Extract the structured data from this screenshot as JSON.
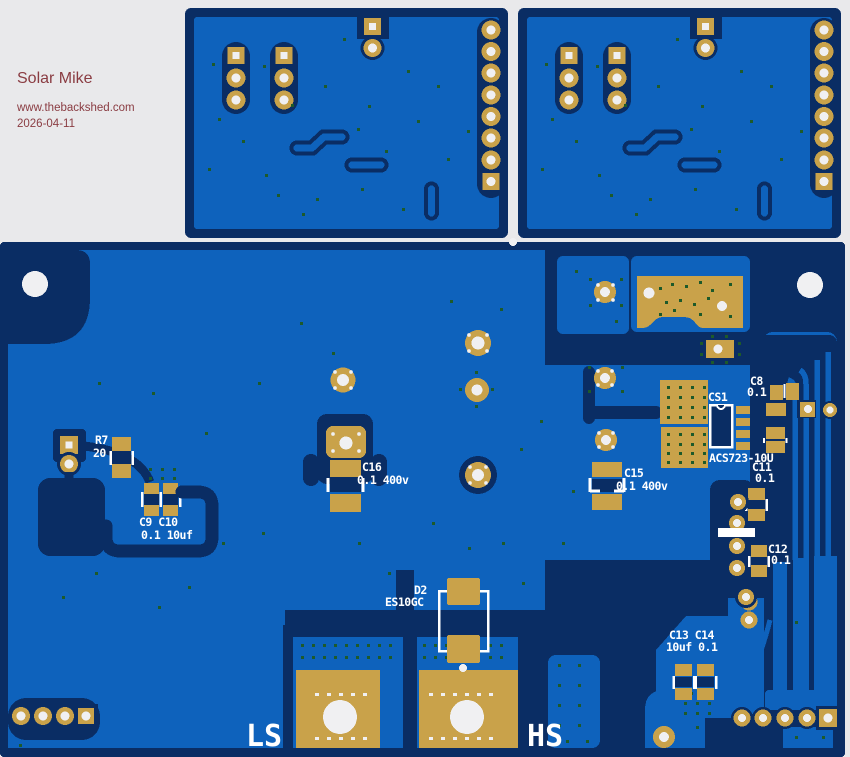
{
  "header": {
    "title": "Solar Mike",
    "url": "www.thebackshed.com",
    "date": "2026-04-11"
  },
  "components": {
    "r7": {
      "ref": "R7",
      "value": "20"
    },
    "c9_c10": {
      "refs": "C9 C10",
      "values": "0.1 10uf"
    },
    "c16": {
      "ref": "C16",
      "value": "0.1 400v"
    },
    "c15": {
      "ref": "C15",
      "value": "0.1 400v"
    },
    "cs1": {
      "ref": "CS1",
      "part": "ACS723-10U"
    },
    "c8": {
      "ref": "C8",
      "value": "0.1"
    },
    "c11": {
      "ref": "C11",
      "value": "0.1"
    },
    "c12": {
      "ref": "C12",
      "value": "0.1"
    },
    "c13_c14": {
      "refs": "C13 C14",
      "values": "10uf 0.1"
    },
    "d2": {
      "ref": "D2",
      "value": "ES10GC"
    }
  },
  "terminals": {
    "low_side": "LS",
    "high_side": "HS"
  },
  "colors": {
    "background_gray": "#e9e9eb",
    "board_blue": "#0e62bc",
    "copper_navy": "#0a2d64",
    "pad_gold": "#c9a24a",
    "silkscreen_white": "#ffffff",
    "via_green": "#1d5a2a",
    "hole_white": "#f0f0f2",
    "header_text": "#8a3c42"
  }
}
